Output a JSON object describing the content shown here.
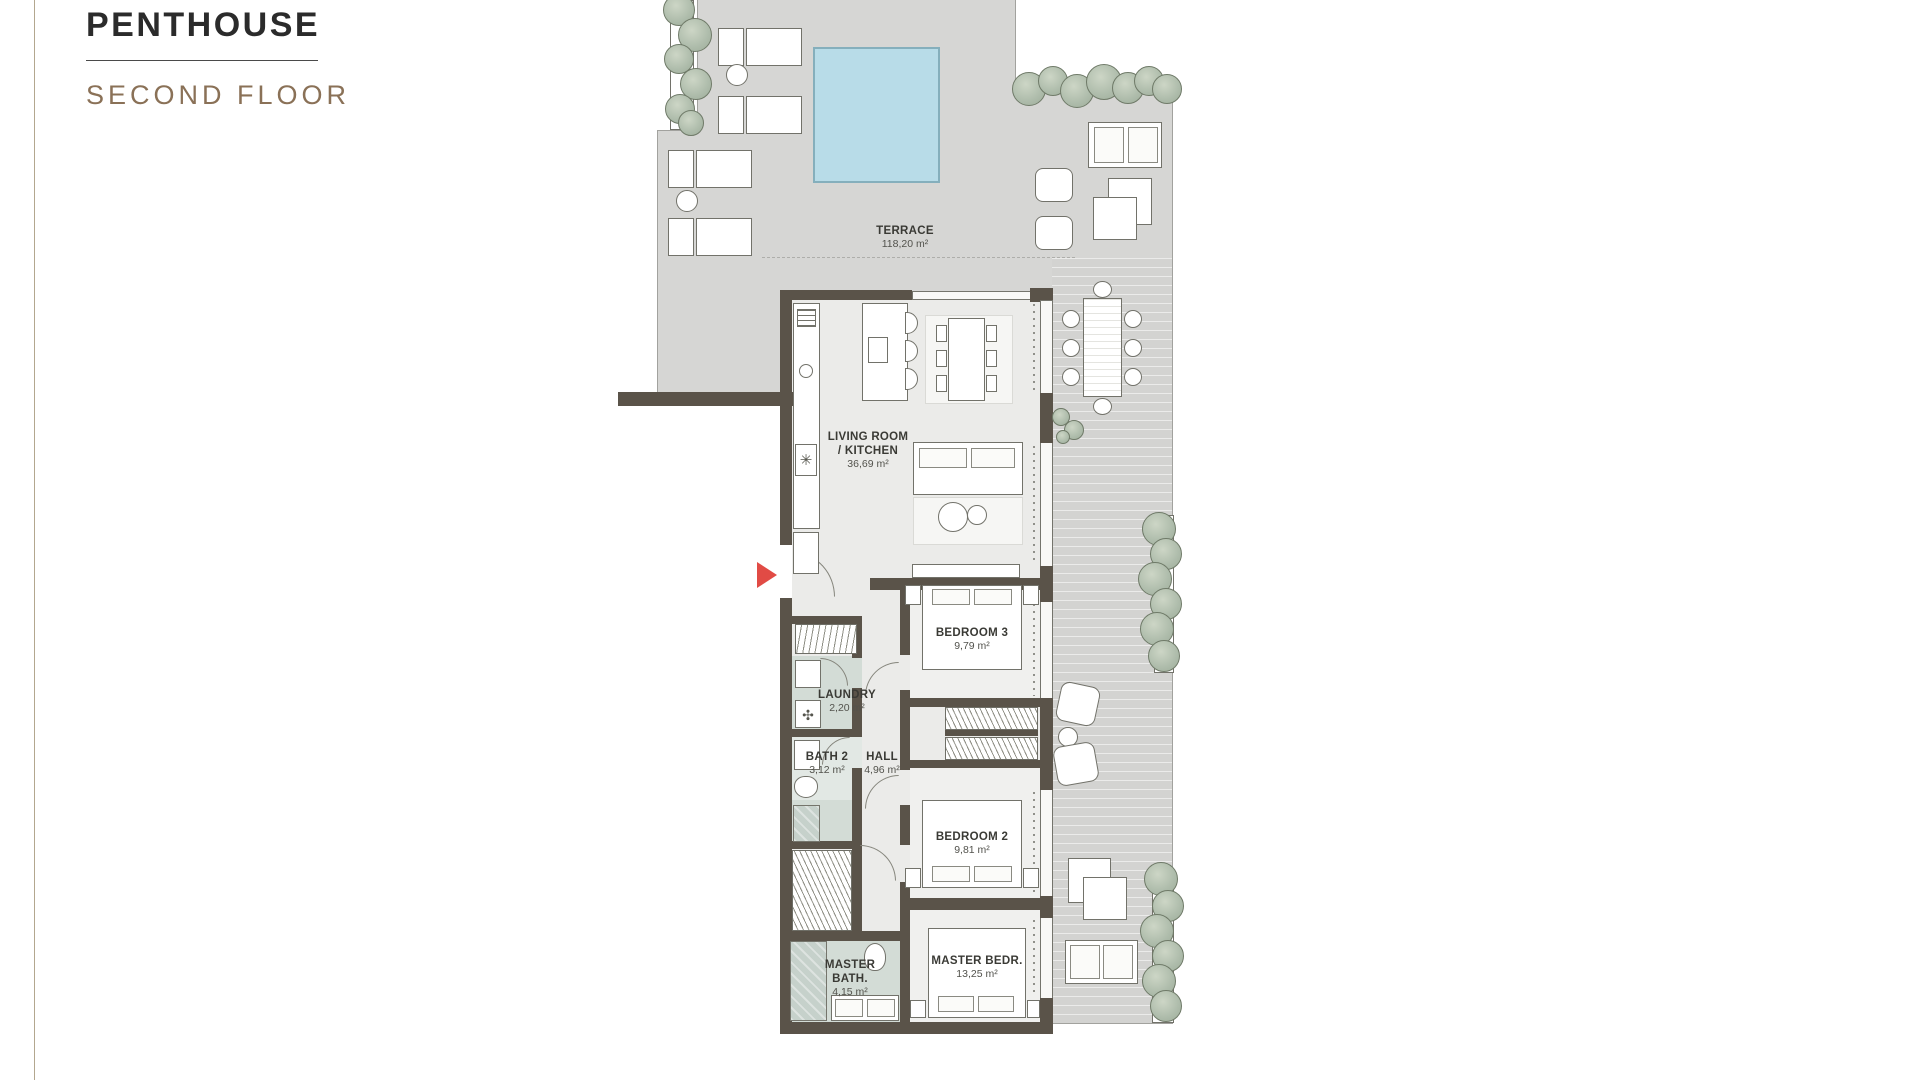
{
  "title": "PENTHOUSE",
  "subtitle": "SECOND FLOOR",
  "rooms": {
    "terrace": {
      "name": "TERRACE",
      "area": "118,20 m²"
    },
    "living": {
      "name": "LIVING ROOM",
      "name2": "/ KITCHEN",
      "area": "36,69  m²"
    },
    "bedroom3": {
      "name": "BEDROOM 3",
      "area": "9,79 m²"
    },
    "laundry": {
      "name": "LAUNDRY",
      "area": "2,20 m²"
    },
    "bath2": {
      "name": "BATH 2",
      "area": "3,12 m²"
    },
    "hall": {
      "name": "HALL",
      "area": "4,96 m²"
    },
    "bedroom2": {
      "name": "BEDROOM 2",
      "area": "9,81 m²"
    },
    "master_bedroom": {
      "name": "MASTER BEDR.",
      "area": "13,25  m²"
    },
    "master_bath": {
      "name": "MASTER",
      "name2": "BATH.",
      "area": "4,15 m²"
    }
  },
  "colors": {
    "accent_red": "#e14b45",
    "title_dark": "#2b2b2b",
    "subtitle_brown": "#8a7157",
    "terrace_gray": "#d6d6d4",
    "pool_blue": "#b8dce8",
    "wall_brown": "#5a5349",
    "plant_green": "#aebcab",
    "wet_room_green": "#d3dcd6"
  }
}
